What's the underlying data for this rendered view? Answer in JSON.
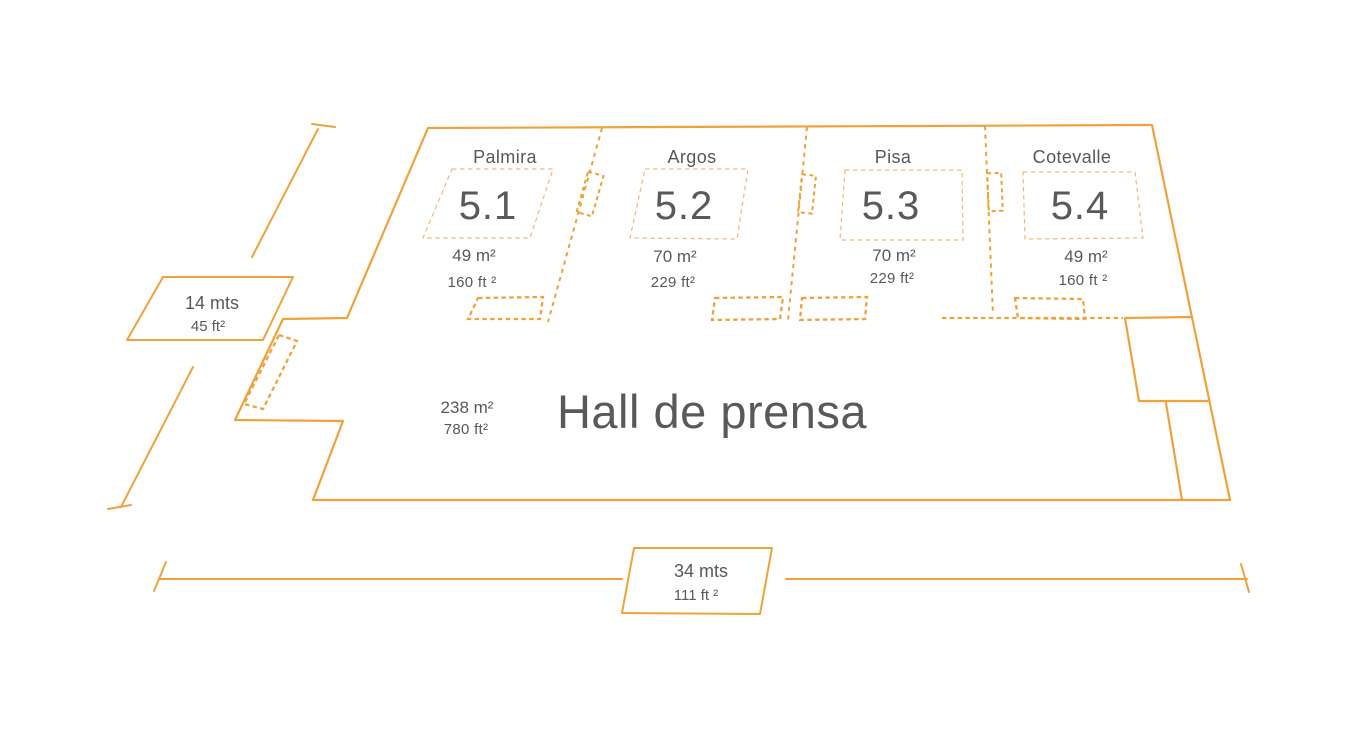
{
  "colors": {
    "outline_orange": "#F0A23A",
    "dashed_light_orange": "#F2B877",
    "text_gray": "#58595B",
    "background": "#FFFFFF"
  },
  "rooms": [
    {
      "name": "Palmira",
      "number": "5.1",
      "area_metric": "49 m²",
      "area_imperial": "160 ft ²"
    },
    {
      "name": "Argos",
      "number": "5.2",
      "area_metric": "70 m²",
      "area_imperial": "229 ft²"
    },
    {
      "name": "Pisa",
      "number": "5.3",
      "area_metric": "70 m²",
      "area_imperial": "229 ft²"
    },
    {
      "name": "Cotevalle",
      "number": "5.4",
      "area_metric": "49 m²",
      "area_imperial": "160 ft ²"
    }
  ],
  "hall": {
    "name": "Hall de prensa",
    "area_metric": "238 m²",
    "area_imperial": "780 ft²"
  },
  "dimensions": {
    "left": {
      "metric": "14 mts",
      "imperial": "45 ft²"
    },
    "bottom": {
      "metric": "34 mts",
      "imperial": "111 ft ²"
    }
  }
}
